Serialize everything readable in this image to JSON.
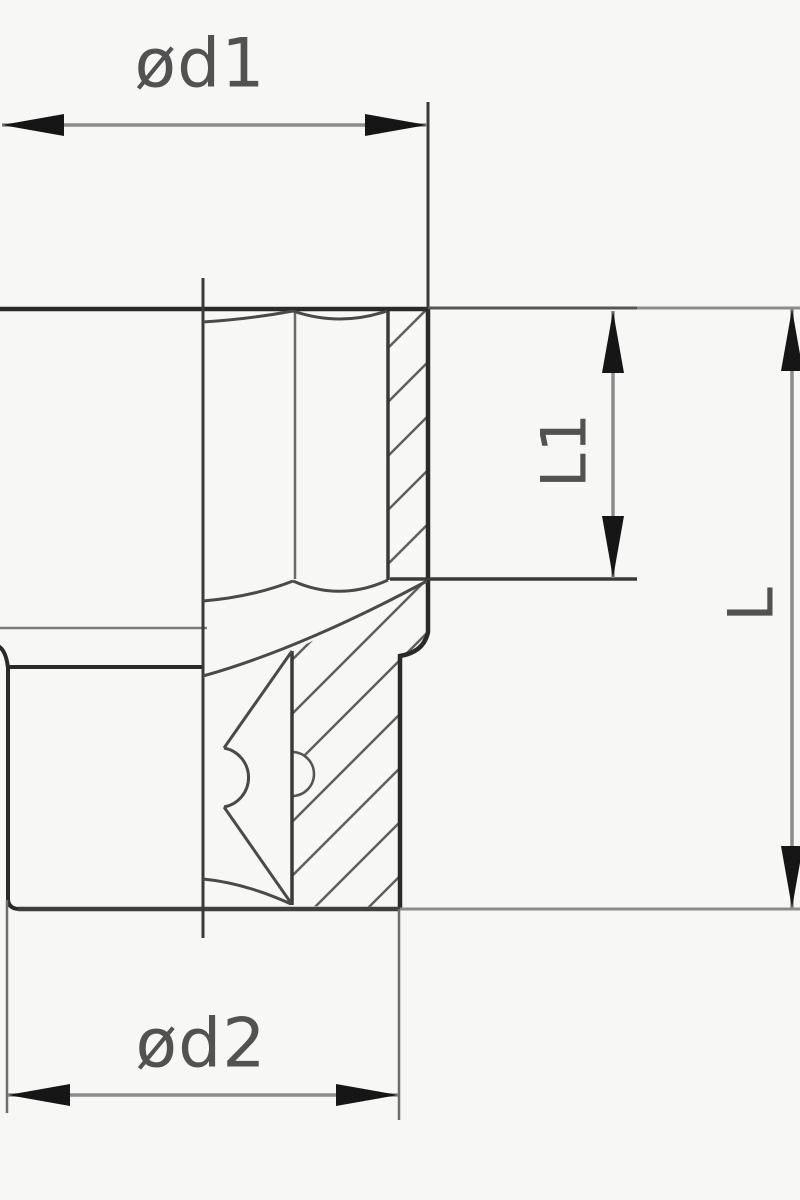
{
  "drawing": {
    "title": "socket-cross-section-technical-drawing",
    "labels": {
      "d1": "ød1",
      "d2": "ød2",
      "l1": "L1",
      "l": "L"
    },
    "colors": {
      "background": "#f7f7f5",
      "outline": "#2a2a2a",
      "inner_line": "#4a4a4a",
      "thin_line": "#6a6a6a",
      "hatch": "#5f5f5f",
      "dimension_line": "#8c8c8c",
      "extension_line": "#6e6e6e",
      "arrow": "#161616",
      "text": "#525252"
    }
  }
}
